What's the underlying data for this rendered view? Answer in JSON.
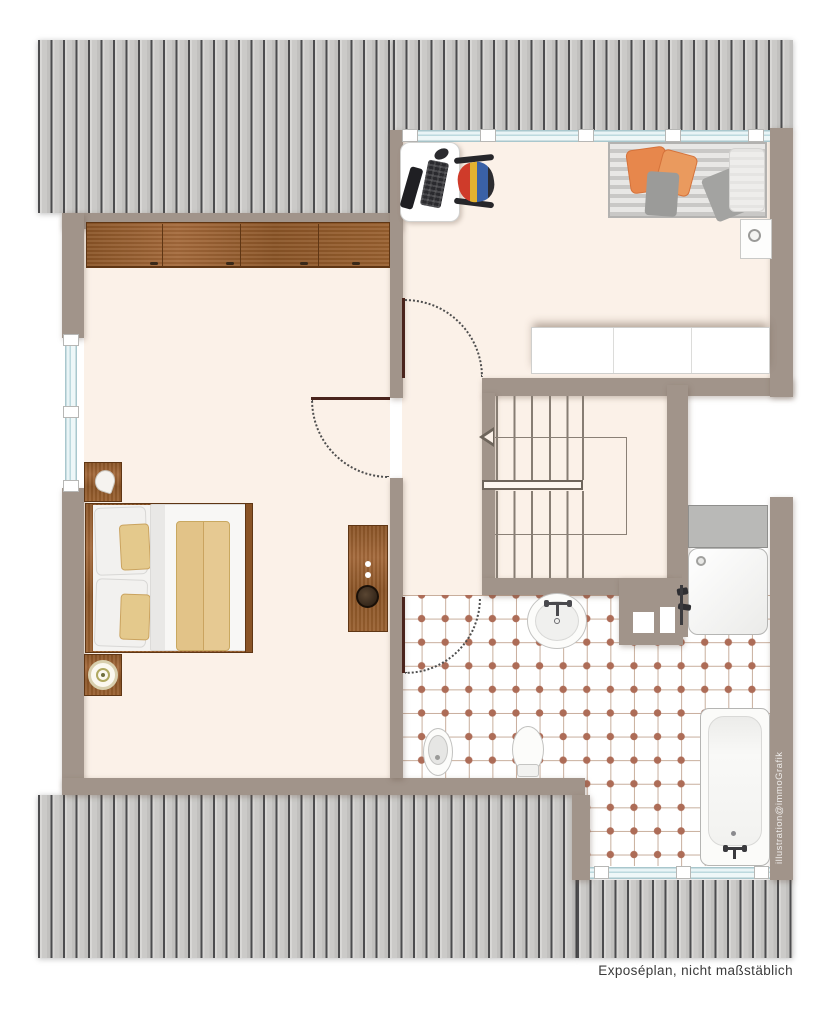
{
  "texts": {
    "footer": "Exposéplan, nicht maßstäblich",
    "watermark": "illustration@immoGrafik"
  },
  "palette": {
    "background": "#ffffff",
    "wall": "#a1948a",
    "floor": "#fbf1e8",
    "roof_plank": "#cbcac8",
    "roof_line": "#4c4c4e",
    "wood": "#8a5426",
    "tile_line": "#c7ad9b",
    "tile_dot": "#ad6c57",
    "window_glass": "#d9ebee",
    "door_leaf": "#4a241c",
    "accent_orange": "#e7874c",
    "bench_gray": "#c9c8c6"
  },
  "plan": {
    "type": "attic floor plan",
    "roof_areas": 4,
    "windows": 3,
    "doors": 3,
    "rooms": [
      {
        "name": "bedroom",
        "furniture": [
          "wardrobe",
          "double-bed",
          "pillows",
          "duvet",
          "yellow-blanket",
          "nightstand-shell",
          "nightstand-lamp",
          "dresser-with-bowl"
        ]
      },
      {
        "name": "study",
        "furniture": [
          "desk",
          "keyboard",
          "monitor",
          "mouse",
          "office-chair",
          "daybed",
          "orange-cushions",
          "gray-cushions",
          "white-pillow",
          "side-table-with-cup",
          "sideboard"
        ]
      },
      {
        "name": "landing",
        "features": [
          "u-shaped-staircase",
          "stair-railing",
          "walking-line",
          "direction-arrow"
        ]
      },
      {
        "name": "bathroom",
        "floor": "tiled",
        "furniture": [
          "washbasin",
          "shower-tray",
          "shower-shelf",
          "bidet",
          "toilet",
          "bathtub",
          "wall-shafts"
        ]
      }
    ]
  }
}
